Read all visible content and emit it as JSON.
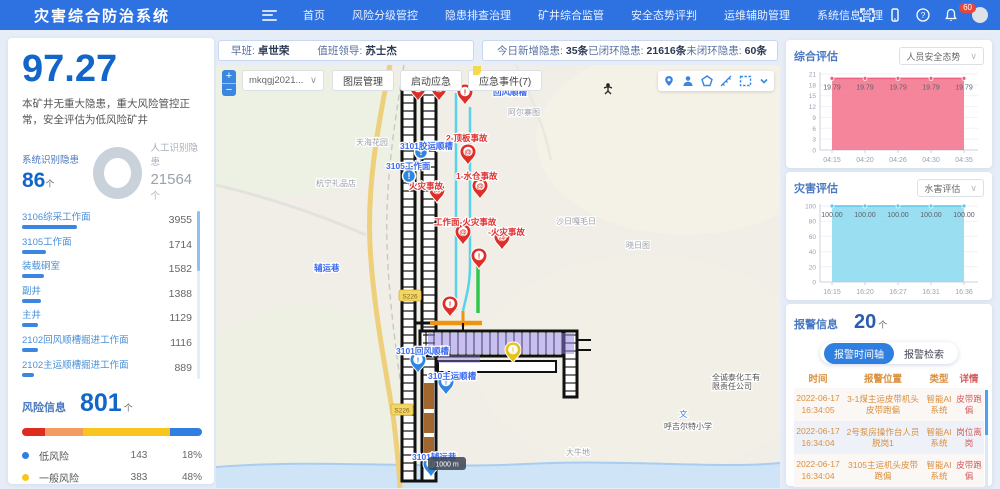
{
  "topbar": {
    "title": "灾害综合防治系统",
    "menu": [
      "首页",
      "风险分级管控",
      "隐患排查治理",
      "矿井综合监管",
      "安全态势评判",
      "运维辅助管理",
      "系统信息管理"
    ],
    "notification_count": "60"
  },
  "info_bar": {
    "shift_label": "早班:",
    "shift_name": "卓世荣",
    "leader_label": "值班领导:",
    "leader_name": "苏士杰",
    "stats": [
      {
        "label": "今日新增隐患:",
        "value": "35条"
      },
      {
        "label": "已闭环隐患:",
        "value": "21616条"
      },
      {
        "label": "未闭环隐患:",
        "value": "60条"
      }
    ]
  },
  "left_panel": {
    "score": "97.27",
    "description": "本矿井无重大隐患，重大风险管控正常，安全评估为低风险矿井",
    "system_label": "系统识别隐患",
    "system_count": "86",
    "system_unit": "个",
    "manual_label": "人工识别隐患",
    "manual_count": "21564",
    "manual_unit": "个",
    "locations": [
      {
        "name": "3106综采工作面",
        "value": 3955
      },
      {
        "name": "3105工作面",
        "value": 1714
      },
      {
        "name": "装载硐室",
        "value": 1582
      },
      {
        "name": "副井",
        "value": 1388
      },
      {
        "name": "主井",
        "value": 1129
      },
      {
        "name": "2102回风顺槽掘进工作面",
        "value": 1116
      },
      {
        "name": "2102主运顺槽掘进工作面",
        "value": 889
      }
    ],
    "risk": {
      "label": "风险信息",
      "count": "801",
      "unit": "个",
      "segments": [
        {
          "color": "#e02b20",
          "pct": 13
        },
        {
          "color": "#f49b63",
          "pct": 21
        },
        {
          "color": "#f7c51e",
          "pct": 48
        },
        {
          "color": "#2f7fe0",
          "pct": 18
        }
      ],
      "legend": [
        {
          "color": "#2f7fe0",
          "name": "低风险",
          "count": "143",
          "pct": "18%"
        },
        {
          "color": "#f7c51e",
          "name": "一般风险",
          "count": "383",
          "pct": "48%"
        },
        {
          "color": "#f49b63",
          "name": "较大风险",
          "count": "169",
          "pct": "21%"
        }
      ]
    }
  },
  "map": {
    "select_value": "mkqgj2021...",
    "layer_button": "图层管理",
    "emergency_button": "启动应急",
    "events_button": "应急事件(7)",
    "scale_label": "1000 m",
    "road_badges": [
      {
        "text": "S226",
        "x": 194,
        "y": 231
      },
      {
        "text": "S226",
        "x": 186,
        "y": 345
      }
    ],
    "markers": [
      {
        "kind": "red-pin",
        "glyph": "!",
        "x": 202,
        "y": 36
      },
      {
        "kind": "red-pin",
        "glyph": "@",
        "x": 223,
        "y": 36
      },
      {
        "kind": "red-pin",
        "glyph": "!",
        "x": 249,
        "y": 40
      },
      {
        "kind": "red-pin",
        "glyph": "@",
        "x": 252,
        "y": 100
      },
      {
        "kind": "red-pin",
        "glyph": "@",
        "x": 221,
        "y": 138
      },
      {
        "kind": "red-pin",
        "glyph": "@",
        "x": 264,
        "y": 134
      },
      {
        "kind": "red-pin",
        "glyph": "@",
        "x": 247,
        "y": 180
      },
      {
        "kind": "red-pin",
        "glyph": "@",
        "x": 286,
        "y": 185
      },
      {
        "kind": "red-pin",
        "glyph": "!",
        "x": 263,
        "y": 204
      },
      {
        "kind": "red-pin",
        "glyph": "!",
        "x": 234,
        "y": 252
      },
      {
        "kind": "blue-dot",
        "glyph": "!",
        "x": 205,
        "y": 95
      },
      {
        "kind": "blue-dot",
        "glyph": "!",
        "x": 193,
        "y": 119
      },
      {
        "kind": "blue-pin",
        "glyph": "!",
        "x": 202,
        "y": 308
      },
      {
        "kind": "blue-pin",
        "glyph": "!",
        "x": 230,
        "y": 330
      },
      {
        "kind": "blue-pin",
        "glyph": "!",
        "x": 215,
        "y": 412
      },
      {
        "kind": "yellow-pin",
        "glyph": "!",
        "x": 297,
        "y": 298
      }
    ],
    "labels": [
      {
        "text": "回风顺槽",
        "color": "blue",
        "x": 277,
        "y": 30
      },
      {
        "text": "2-顶板事故",
        "color": "red",
        "x": 230,
        "y": 76
      },
      {
        "text": "1-水仓事故",
        "color": "red",
        "x": 240,
        "y": 114
      },
      {
        "text": "3101胶运顺槽",
        "color": "blue",
        "x": 184,
        "y": 84
      },
      {
        "text": "3105工作面",
        "color": "blue",
        "x": 170,
        "y": 104
      },
      {
        "text": "火灾事故",
        "color": "red",
        "x": 193,
        "y": 124
      },
      {
        "text": "工作面-火灾事故",
        "color": "red",
        "x": 218,
        "y": 160
      },
      {
        "text": "-火灾事故",
        "color": "red",
        "x": 272,
        "y": 170
      },
      {
        "text": "3101回风顺槽",
        "color": "blue",
        "x": 180,
        "y": 289
      },
      {
        "text": "310主运顺槽",
        "color": "blue",
        "x": 212,
        "y": 314
      },
      {
        "text": "3101辅运巷",
        "color": "blue",
        "x": 196,
        "y": 395
      },
      {
        "text": "辅运巷",
        "color": "blue",
        "x": 98,
        "y": 206
      },
      {
        "text": "天海花园",
        "color": "gray",
        "x": 140,
        "y": 80
      },
      {
        "text": "杭宁礼品店",
        "color": "gray",
        "x": 100,
        "y": 121
      },
      {
        "text": "阿尔寨图",
        "color": "gray",
        "x": 292,
        "y": 50
      },
      {
        "text": "沙日嘎毛日",
        "color": "gray",
        "x": 340,
        "y": 159
      },
      {
        "text": "晓日图",
        "color": "gray",
        "x": 410,
        "y": 183
      },
      {
        "text": "大牛地",
        "color": "gray",
        "x": 350,
        "y": 390
      },
      {
        "text": "文",
        "color": "school",
        "x": 463,
        "y": 352
      },
      {
        "text": "呼吉尔特小学",
        "color": "dark",
        "x": 448,
        "y": 364
      },
      {
        "text": "全诚泰化工有|限责任公司",
        "color": "dark",
        "x": 496,
        "y": 315
      }
    ]
  },
  "chart_data": [
    {
      "type": "area",
      "panel_title": "综合评估",
      "selector": "人员安全态势",
      "x": [
        "04:15",
        "04:20",
        "04:26",
        "04:30",
        "04:35"
      ],
      "values": [
        19.79,
        19.79,
        19.79,
        19.79,
        19.79
      ],
      "point_labels": [
        "19.79",
        "19.79",
        "19.79",
        "19.79",
        "19.79"
      ],
      "ylim": [
        0,
        21
      ],
      "yticks": [
        0,
        3,
        6,
        9,
        12,
        15,
        18,
        21
      ],
      "line_color": "#ee5f80",
      "fill_color": "#f4788f",
      "fill_opacity": 0.9,
      "grid": true,
      "legend_position": "none"
    },
    {
      "type": "area",
      "panel_title": "灾害评估",
      "selector": "水害评估",
      "x": [
        "16:15",
        "16:20",
        "16:27",
        "16:31",
        "16:36"
      ],
      "values": [
        100,
        100,
        100,
        100,
        100
      ],
      "point_labels": [
        "100.00",
        "100.00",
        "100.00",
        "100.00",
        "100.00"
      ],
      "ylim": [
        0,
        100
      ],
      "yticks": [
        0,
        20,
        40,
        60,
        80,
        100
      ],
      "line_color": "#5fc6e4",
      "fill_color": "#8edcf0",
      "fill_opacity": 0.9,
      "grid": true,
      "legend_position": "none"
    }
  ],
  "alarm_panel": {
    "title": "报警信息",
    "count": "20",
    "unit": "个",
    "tabs": [
      {
        "label": "报警时间轴",
        "active": true
      },
      {
        "label": "报警检索",
        "active": false
      }
    ],
    "columns": [
      "时间",
      "报警位置",
      "类型",
      "详情"
    ],
    "rows": [
      {
        "time": "2022-06-17 16:34:05",
        "location": "3-1煤主运皮带机头皮带跑偏",
        "type": "智能AI系统",
        "detail": "皮带跑偏"
      },
      {
        "time": "2022-06-17 16:34:04",
        "location": "2号泵房操作台人员脱岗1",
        "type": "智能AI系统",
        "detail": "岗位离岗"
      },
      {
        "time": "2022-06-17 16:34:04",
        "location": "3105主运机头皮带跑偏",
        "type": "智能AI系统",
        "detail": "皮带跑偏"
      }
    ]
  }
}
